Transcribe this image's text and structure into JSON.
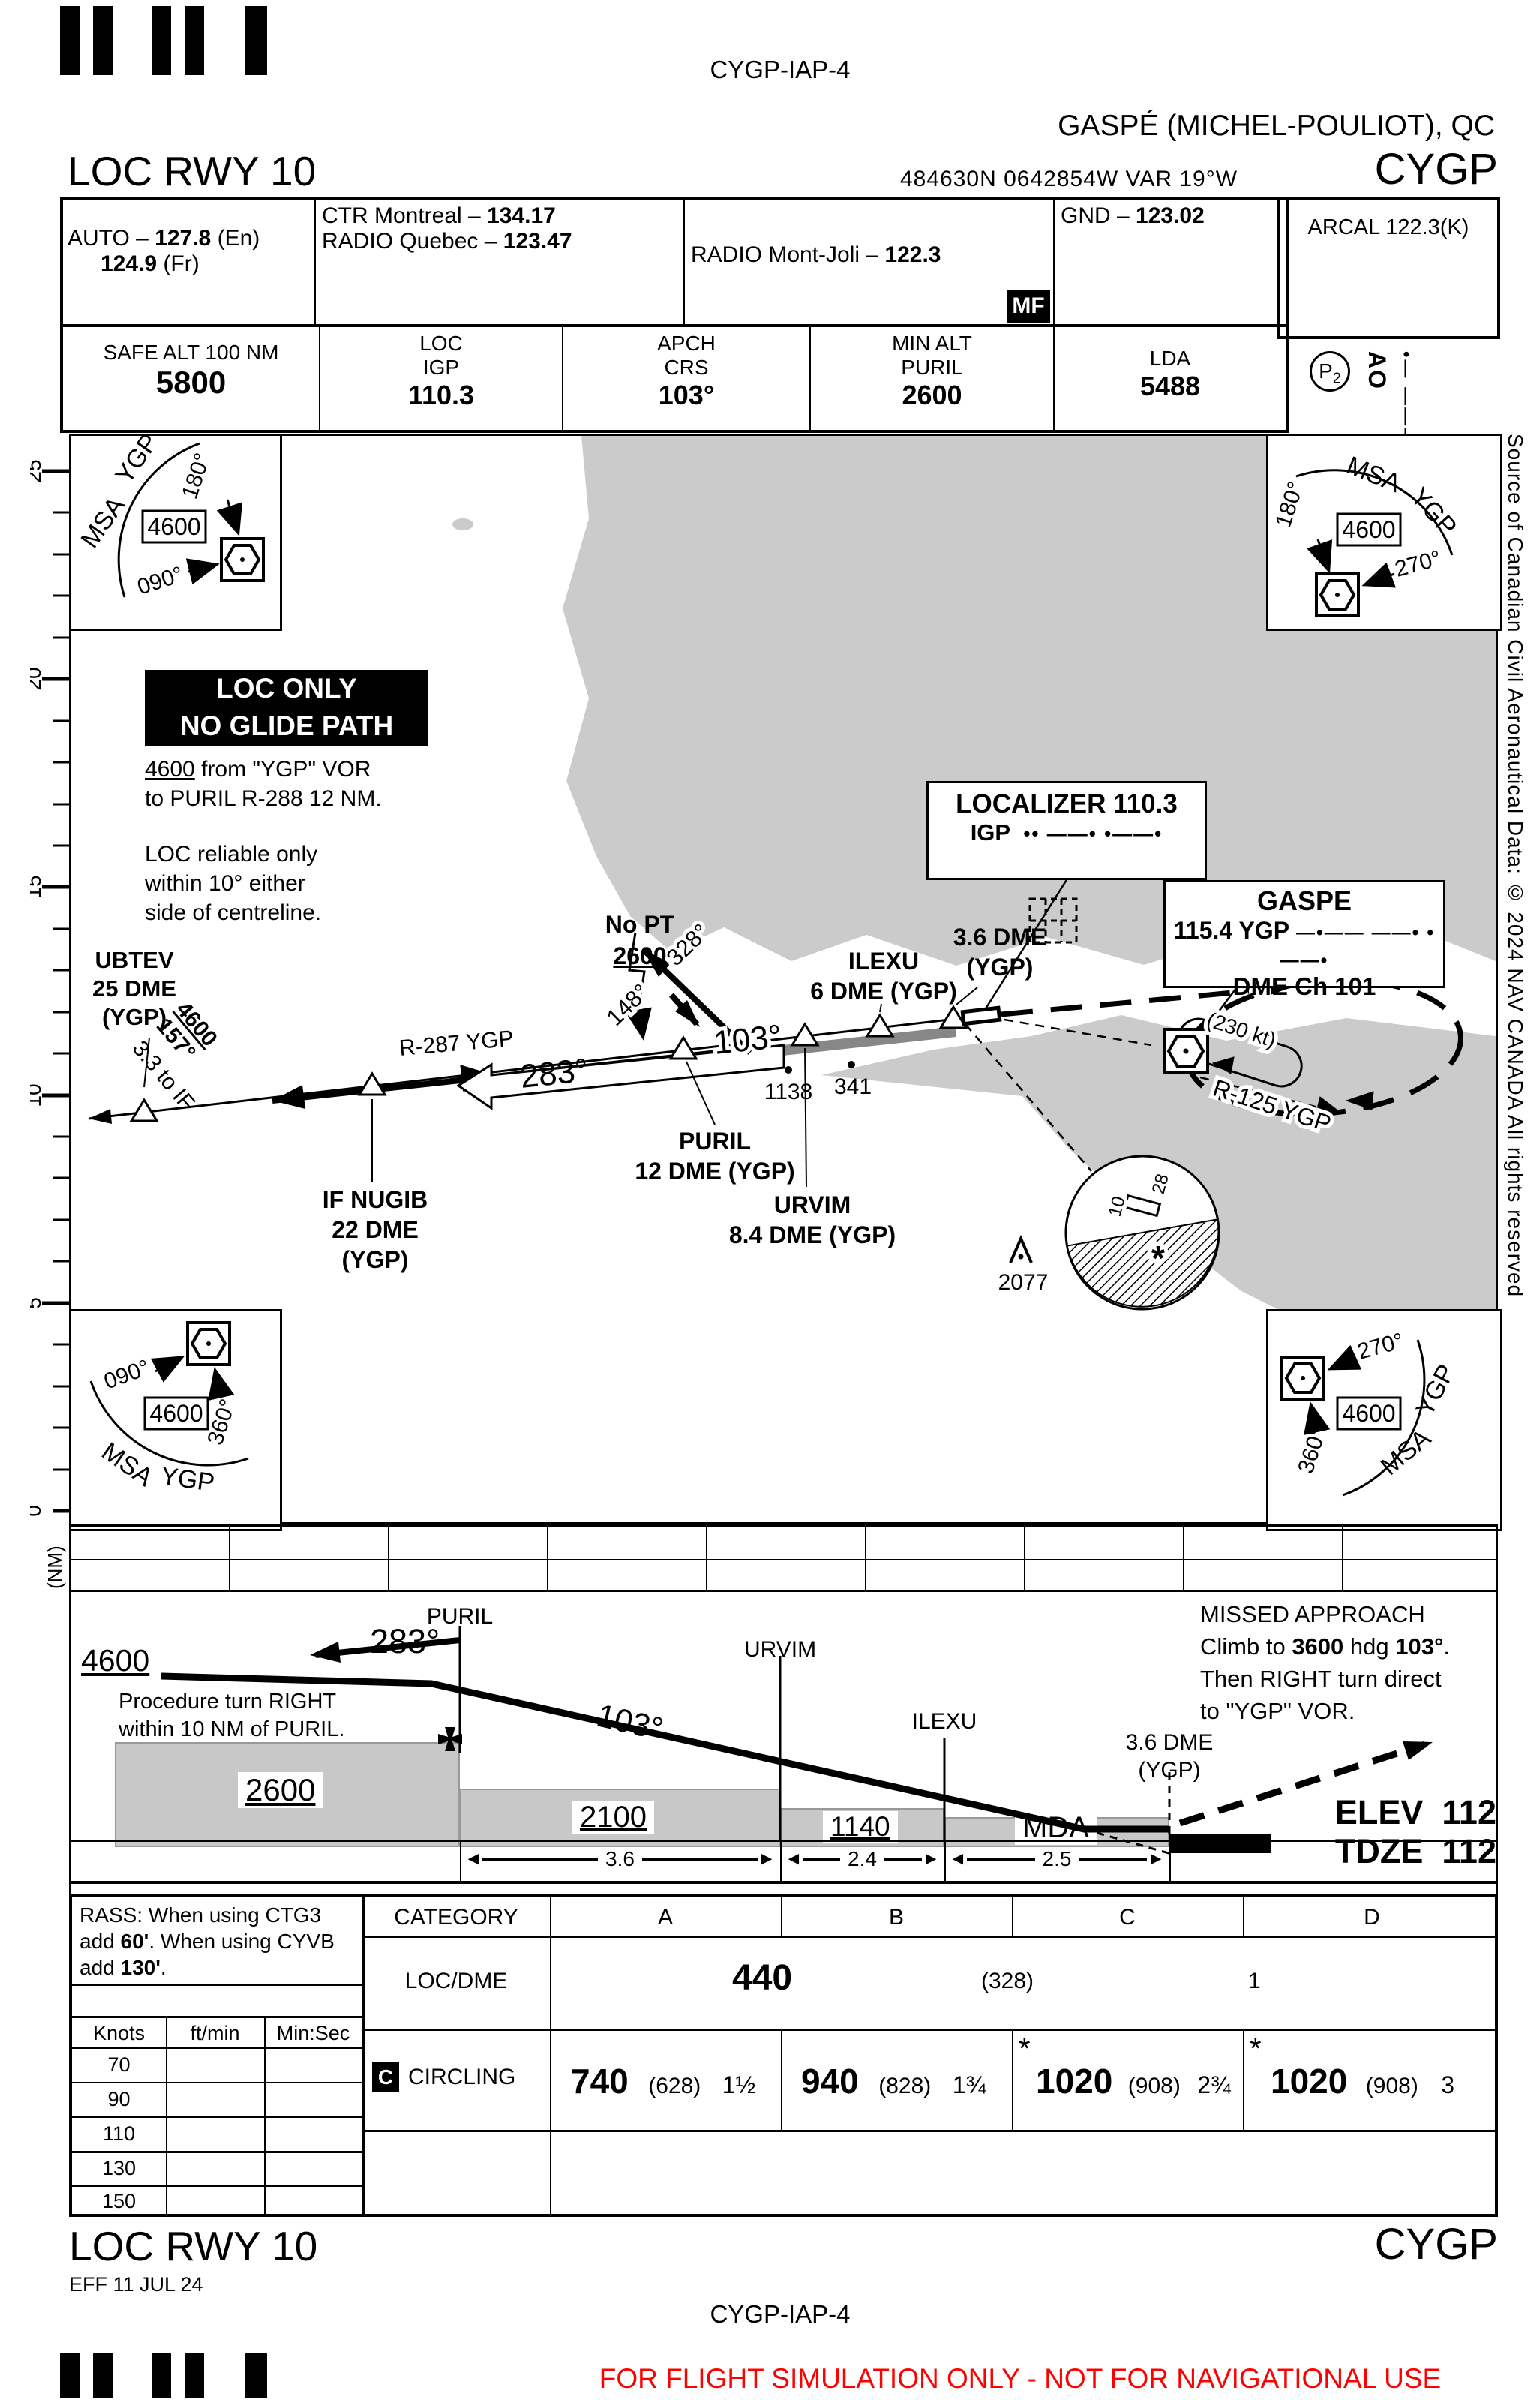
{
  "page": {
    "chart_id": "CYGP-IAP-4",
    "airport_title": "GASPÉ (MICHEL-POULIOT), QC",
    "procedure_title": "LOC RWY 10",
    "icao": "CYGP",
    "coordinates": "484630N  0642854W  VAR 19°W",
    "effective_date": "EFF 11 JUL 24",
    "disclaimer": "FOR FLIGHT SIMULATION ONLY - NOT FOR NAVIGATIONAL USE",
    "source_note": "Source of Canadian Civil Aeronautical Data: © 2024 NAV CANADA All rights reserved"
  },
  "comm": {
    "auto": {
      "pre": "AUTO – ",
      "freq": "127.8",
      "post": " (En)",
      "freq2": "124.9",
      "post2": " (Fr)"
    },
    "ctr": {
      "pre": "CTR Montreal – ",
      "freq": "134.17"
    },
    "radio_quebec": {
      "pre": "RADIO Quebec – ",
      "freq": "123.47"
    },
    "radio_montjoli": {
      "pre": "RADIO Mont-Joli – ",
      "freq": "122.3"
    },
    "gnd": {
      "pre": "GND – ",
      "freq": "123.02"
    },
    "mf": "MF",
    "arcal": {
      "label": "ARCAL 122.3(K)",
      "p": "P",
      "p_sub": "2",
      "ident": "AO",
      "morse": "•—  ———"
    }
  },
  "databoxes": {
    "safe_alt": {
      "label": "SAFE ALT 100 NM",
      "value": "5800"
    },
    "loc": {
      "l1": "LOC",
      "l2": "IGP",
      "value": "110.3"
    },
    "apch": {
      "l1": "APCH",
      "l2": "CRS",
      "value": "103°"
    },
    "min_alt": {
      "l1": "MIN ALT",
      "l2": "PURIL",
      "value": "2600"
    },
    "lda": {
      "label": "LDA",
      "value": "5488"
    }
  },
  "plan": {
    "ruler": {
      "labels": [
        "25",
        "20",
        "15",
        "10",
        "5",
        "0"
      ],
      "unit": "(NM)"
    },
    "msa": {
      "label": "MSA",
      "navaid": "YGP",
      "altitude": "4600",
      "b090": "090°",
      "b180": "180°",
      "b270": "270°",
      "b360": "360°"
    },
    "loc_only": {
      "l1": "LOC ONLY",
      "l2": "NO GLIDE PATH"
    },
    "note1": {
      "alt": "4600",
      "rest": " from \"YGP\" VOR",
      "l2": "to PURIL R-288 12 NM."
    },
    "note2": {
      "l1": "LOC reliable only",
      "l2": "within 10° either",
      "l3": "side of centreline."
    },
    "localizer_box": {
      "l1": "LOCALIZER 110.3",
      "ident": "IGP",
      "morse": "••  ——•  •——•"
    },
    "gaspe_box": {
      "l1": "GASPE",
      "l2": "115.4 YGP",
      "morse": "—•——  ——•  •——•",
      "l3": "DME Ch 101"
    },
    "fixes": {
      "ubtev": {
        "l1": "UBTEV",
        "l2": "25 DME",
        "l3": "(YGP)"
      },
      "nugib": {
        "l1": "IF NUGIB",
        "l2": "22 DME",
        "l3": "(YGP)"
      },
      "puril": {
        "l1": "PURIL",
        "l2": "12 DME (YGP)"
      },
      "urvim": {
        "l1": "URVIM",
        "l2": "8.4 DME (YGP)"
      },
      "ilexu": {
        "l1": "ILEXU",
        "l2": "6 DME (YGP)"
      },
      "dme36": {
        "l1": "3.6 DME",
        "l2": "(YGP)"
      }
    },
    "labels": {
      "to_if": "3.3 to IF",
      "leg_alt": "4600",
      "leg_crs": "157°",
      "r287": "R-287 YGP",
      "outbound": "283°",
      "pt_148": "148°",
      "pt_328": "328°",
      "nopt": "No PT",
      "nopt_alt": "2600",
      "inbound": "103°",
      "spot1": "1138",
      "spot2": "341",
      "obstacle": "2077",
      "hold_speed": "(230 kt)",
      "r125": "R-125 YGP",
      "rwy10": "10",
      "rwy28": "28",
      "star": "*"
    }
  },
  "profile": {
    "alt_start": "4600",
    "outbound": "283°",
    "pt_note1": "Procedure turn RIGHT",
    "pt_note2": "within 10 NM of PURIL.",
    "inbound": "103°",
    "puril": "PURIL",
    "urvim": "URVIM",
    "ilexu": "ILEXU",
    "dme36_l1": "3.6 DME",
    "dme36_l2": "(YGP)",
    "blocks": {
      "b1": "2600",
      "b2": "2100",
      "b3": "1140",
      "b4": "MDA"
    },
    "dist": {
      "d1": "3.6",
      "d2": "2.4",
      "d3": "2.5"
    },
    "missed": {
      "l1": "MISSED APPROACH",
      "l2_pre": "Climb to ",
      "l2_alt": "3600",
      "l2_mid": " hdg ",
      "l2_hdg": "103°",
      "l2_post": ".",
      "l3": "Then RIGHT turn direct",
      "l4": "to \"YGP\" VOR."
    },
    "elev": {
      "label": "ELEV",
      "value": "112"
    },
    "tdze": {
      "label": "TDZE",
      "value": "112"
    }
  },
  "minima": {
    "rass": {
      "l1": "RASS: When using CTG3",
      "l2_pre": "add ",
      "l2_b": "60'",
      "l2_post": ". When using CYVB",
      "l3_pre": "add ",
      "l3_b": "130'",
      "l3_post": "."
    },
    "speed": {
      "headers": [
        "Knots",
        "ft/min",
        "Min:Sec"
      ],
      "rows": [
        "70",
        "90",
        "110",
        "130",
        "150"
      ]
    },
    "category_label": "CATEGORY",
    "categories": [
      "A",
      "B",
      "C",
      "D"
    ],
    "locdme": {
      "label": "LOC/DME",
      "mda": "440",
      "hat": "(328)",
      "vis": "1"
    },
    "circling": {
      "badge": "C",
      "label": "CIRCLING",
      "a": {
        "mda": "740",
        "hat": "(628)",
        "vis": "1½"
      },
      "b": {
        "mda": "940",
        "hat": "(828)",
        "vis": "1¾"
      },
      "c": {
        "star": "*",
        "mda": "1020",
        "hat": "(908)",
        "vis": "2¾"
      },
      "d": {
        "star": "*",
        "mda": "1020",
        "hat": "(908)",
        "vis": "3"
      }
    }
  }
}
